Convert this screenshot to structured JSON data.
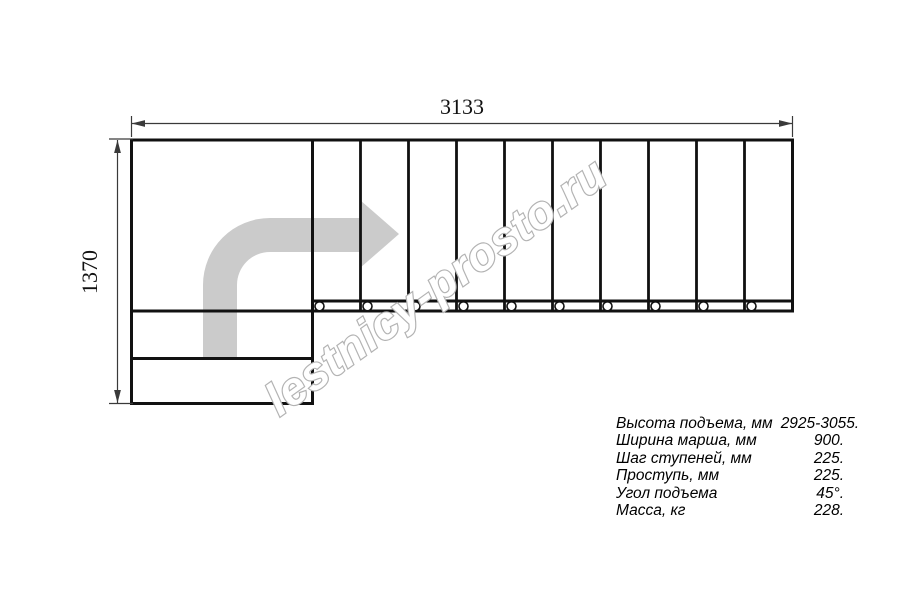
{
  "page": {
    "background": "#ffffff"
  },
  "drawing": {
    "top_dimension_label": "3133",
    "left_dimension_label": "1370",
    "watermark": "lestnicy-prosto.ru",
    "steps_count": 10,
    "arrow_color": "#cbcbcb",
    "watermark_color": "#b3b3b3",
    "line_color": "#111111"
  },
  "specs": {
    "rows": [
      {
        "label": "Высота подъема, мм",
        "value": "2925-3055."
      },
      {
        "label": "Ширина марша, мм",
        "value": "900."
      },
      {
        "label": "Шаг ступеней, мм",
        "value": "225."
      },
      {
        "label": "Проступь, мм",
        "value": "225."
      },
      {
        "label": "Угол подъема",
        "value": "45°."
      },
      {
        "label": "Масса, кг",
        "value": "228."
      }
    ]
  }
}
